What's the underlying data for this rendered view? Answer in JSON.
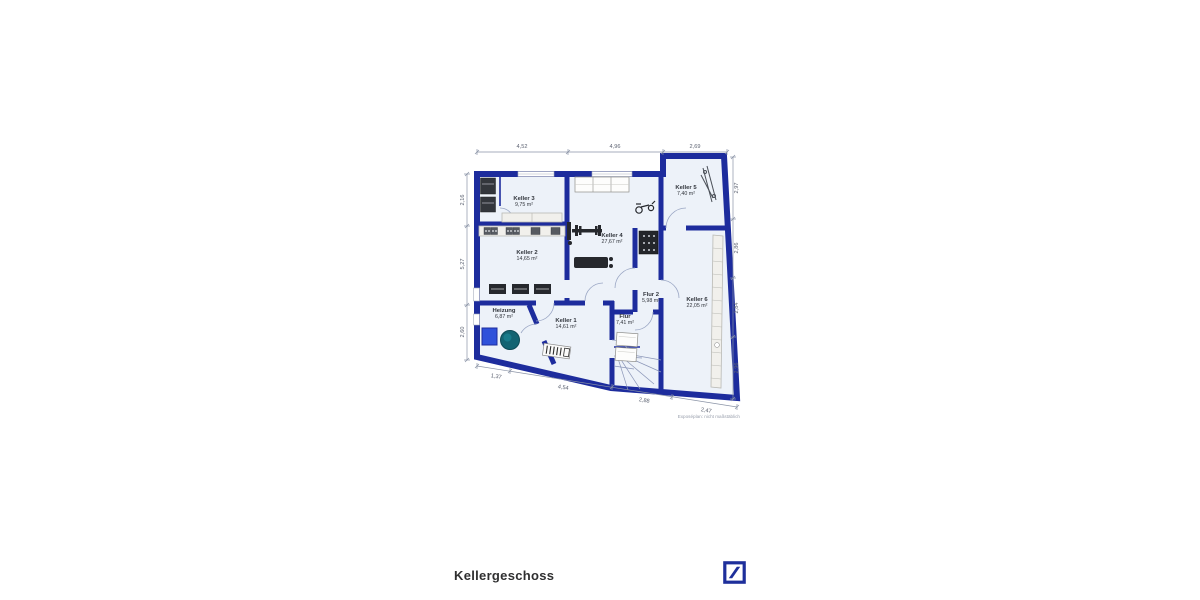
{
  "footer": {
    "floor_label": "Kellergeschoss",
    "logo": "deutsche-bank-logo"
  },
  "plan": {
    "note": "Exposéplan: nicht maßstäblich",
    "colors": {
      "wall": "#1d2c9d",
      "floor": "#edf2f9",
      "dim": "#8a93a6",
      "furniture_dark": "#26282d",
      "tank_blue": "#2f51da",
      "boiler_teal": "#136472",
      "logo_blue": "#1e2f9b"
    },
    "rooms": [
      {
        "name": "Keller 3",
        "area": "9,75 m²"
      },
      {
        "name": "Keller 2",
        "area": "14,65 m²"
      },
      {
        "name": "Keller 4",
        "area": "27,67 m²"
      },
      {
        "name": "Keller 5",
        "area": "7,40 m²"
      },
      {
        "name": "Keller 6",
        "area": "22,05 m²"
      },
      {
        "name": "Flur 2",
        "area": "5,98 m²"
      },
      {
        "name": "Flur",
        "area": "7,41 m²"
      },
      {
        "name": "Heizung",
        "area": "6,87 m²"
      },
      {
        "name": "Keller 1",
        "area": "14,61 m²"
      }
    ],
    "dimensions": {
      "top": [
        "4,52",
        "4,96",
        "2,69"
      ],
      "left": [
        "2,16",
        "5,27",
        "2,60"
      ],
      "right": [
        "2,97",
        "2,86",
        "2,84",
        "2,96"
      ],
      "bottom": [
        "1,37",
        "4,54",
        "2,88",
        "2,47"
      ]
    }
  }
}
